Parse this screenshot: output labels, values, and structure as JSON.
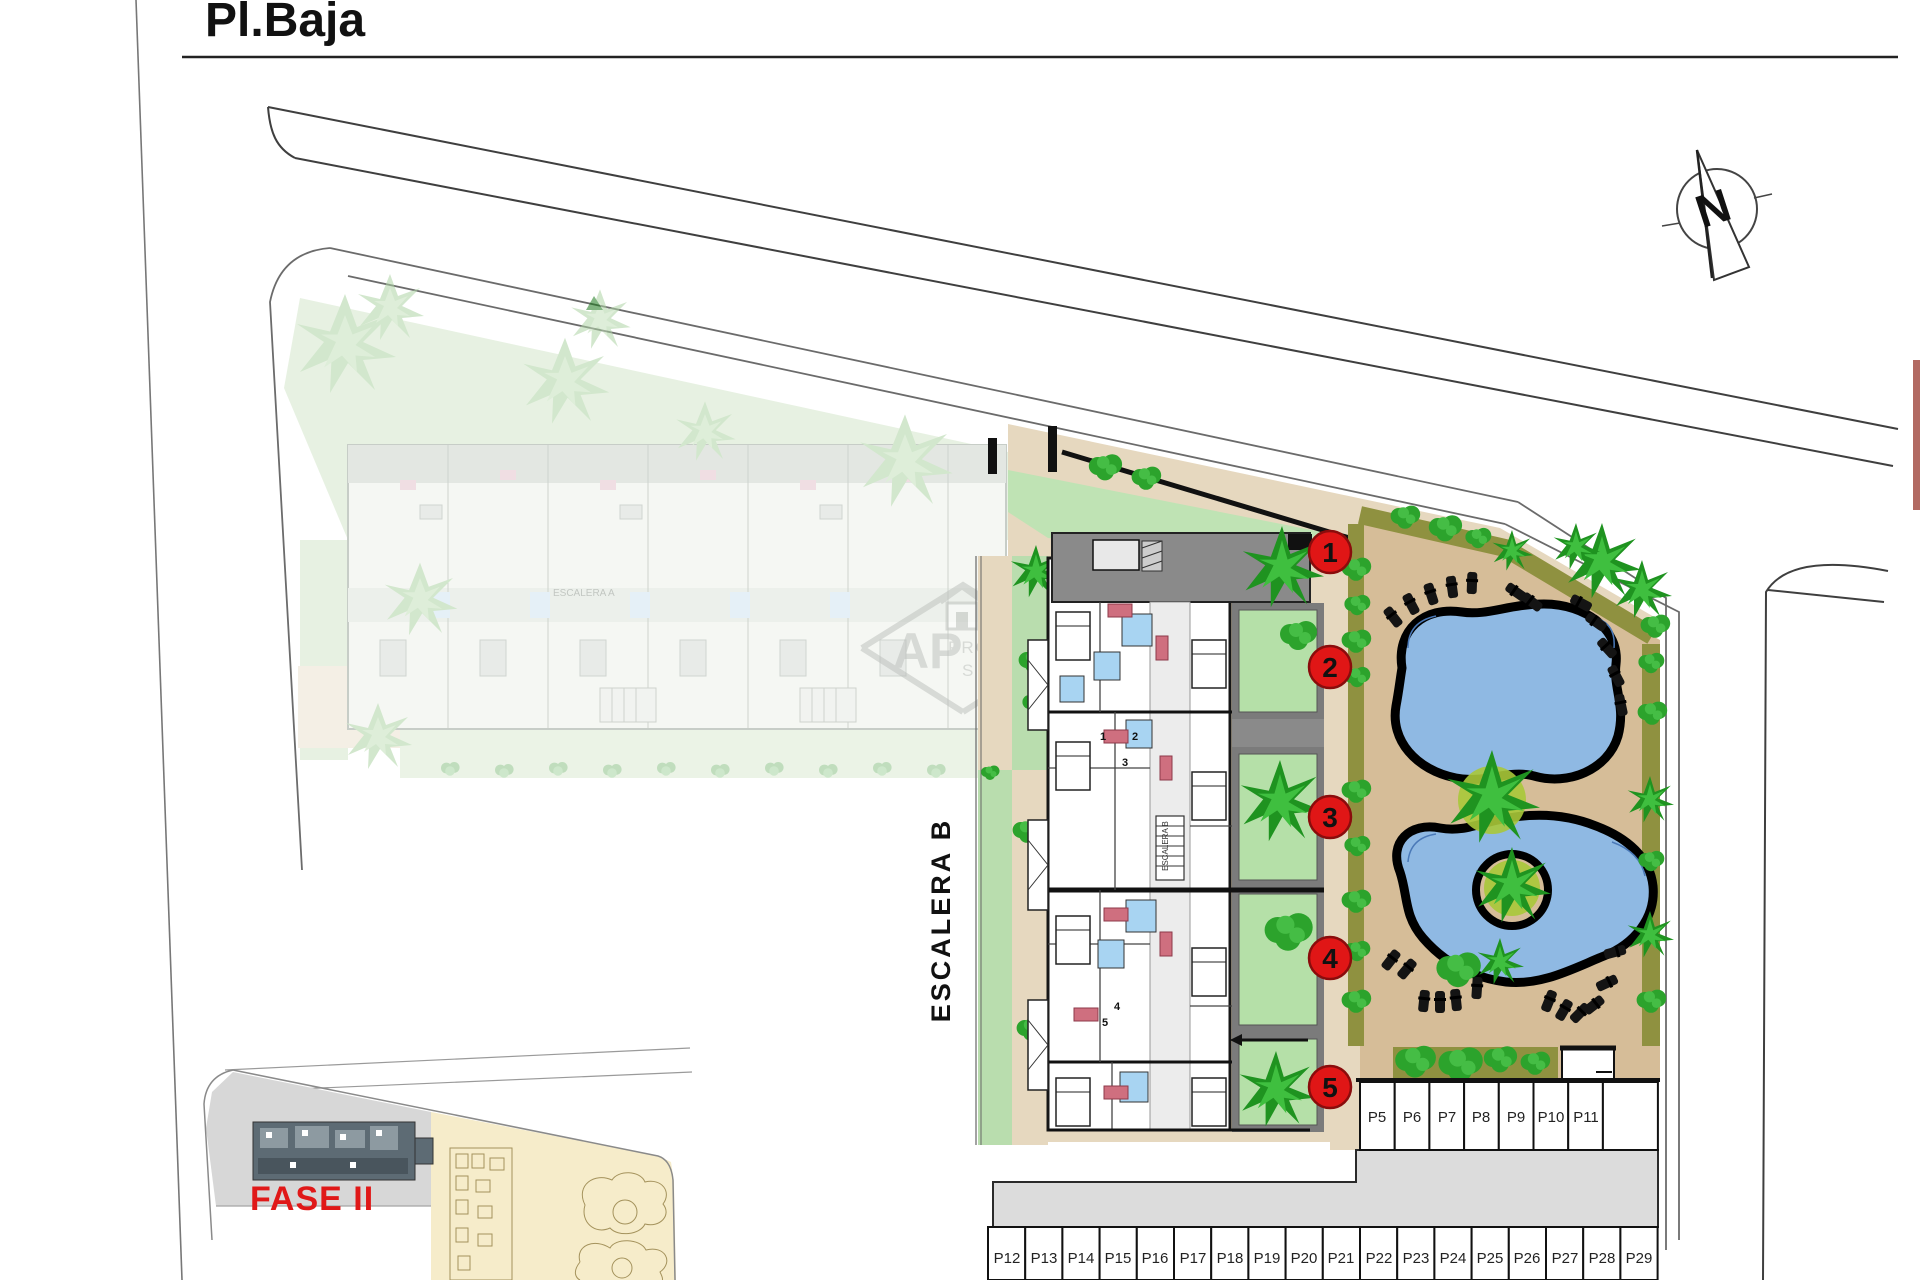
{
  "page": {
    "title": "Pl.Baja"
  },
  "compass": {
    "north_label": "N"
  },
  "site": {
    "phase_label": "FASE II",
    "stair_a_label": "ESCALERA A",
    "stair_b_label": "ESCALERA B",
    "stair_b_plan_label": "ESCALERA B",
    "unit_markers": [
      "1",
      "2",
      "3",
      "4",
      "5"
    ],
    "unit_plan_numbers": [
      "1",
      "2",
      "3",
      "4",
      "5"
    ]
  },
  "parking": {
    "upper_row": [
      "P5",
      "P6",
      "P7",
      "P8",
      "P9",
      "P10",
      "P11"
    ],
    "lower_row": [
      "P12",
      "P13",
      "P14",
      "P15",
      "P16",
      "P17",
      "P18",
      "P19",
      "P20",
      "P21",
      "P22",
      "P23",
      "P24",
      "P25",
      "P26",
      "P27",
      "P28",
      "P29"
    ]
  },
  "watermark": {
    "line1": "AP",
    "line2": "PROPERTIES",
    "line3": "SPAIN"
  },
  "colors": {
    "marker_red": "#e01616",
    "phase_red": "#e01818",
    "pool_blue": "#8fb9e3",
    "grass_green": "#b5e0a8",
    "hedge_olive": "#8f9140",
    "ground_tan": "#d6bd98",
    "walkway_tan": "#e6d8bf",
    "terrace_gray": "#8a8a8a",
    "road_gray": "#dcdcdc",
    "inset_yellow": "#f6ecca"
  }
}
